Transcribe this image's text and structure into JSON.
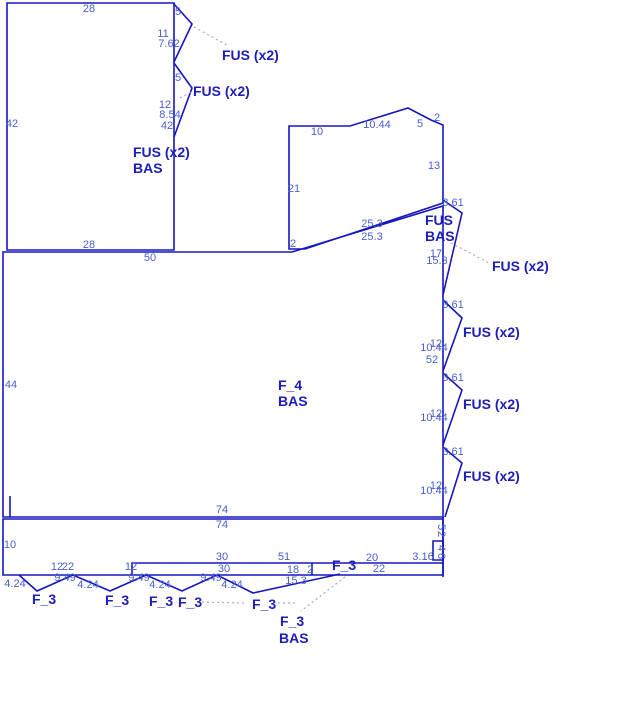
{
  "diagram": {
    "title": "structural layout sketch",
    "colors": {
      "background": "#ffffff",
      "line": "#1616c0",
      "dim_text": "#4a5ed2",
      "label_text": "#1d1db8",
      "leader": "#a0aadc"
    },
    "shapes_closed": [
      {
        "name": "rect-top-left",
        "points": "7,3 174,3 174,250 7,250"
      },
      {
        "name": "shape-upper-right",
        "points": "289,126 350,126 408,108 431,120 443,125 443,203 305,249 289,249"
      },
      {
        "name": "panel-f4",
        "points": "3,252 292,252 443,206 443,517 3,517"
      },
      {
        "name": "strip-bottom",
        "points": "3,519 443,519 443,575 3,575"
      },
      {
        "name": "small-rect",
        "points": "433,541 443,541 443,560 433,560"
      }
    ],
    "shapes_open": [
      {
        "name": "flag-top-1",
        "points": "174,4 192,24 174,62"
      },
      {
        "name": "flag-top-2",
        "points": "174,63 192,88 174,137"
      },
      {
        "name": "flag-right-1",
        "points": "443,200 462,213 443,295"
      },
      {
        "name": "flag-right-2",
        "points": "443,300 462,318 443,371"
      },
      {
        "name": "flag-right-3",
        "points": "443,373 462,390 443,445"
      },
      {
        "name": "flag-right-4",
        "points": "443,447 462,463 445,517"
      },
      {
        "name": "rib-rect",
        "points": "132,575 132,563 443,563"
      },
      {
        "name": "tri-1",
        "points": "19,575 37,591 73,575"
      },
      {
        "name": "tri-2",
        "points": "73,575 110,591 146,575"
      },
      {
        "name": "tri-3",
        "points": "146,575 182,591 217,575"
      },
      {
        "name": "tri-4",
        "points": "217,575 253,593 340,574"
      }
    ],
    "segments": [
      {
        "name": "rib-divider",
        "x1": 312,
        "y1": 563,
        "x2": 312,
        "y2": 575
      },
      {
        "name": "left-stub",
        "x1": 10,
        "y1": 496,
        "x2": 10,
        "y2": 517
      },
      {
        "name": "main-vertical-lower",
        "x1": 443,
        "y1": 517,
        "x2": 443,
        "y2": 577
      }
    ],
    "leaders": [
      {
        "name": "leader-fus-top-1",
        "x1": 194,
        "y1": 27,
        "x2": 227,
        "y2": 45
      },
      {
        "name": "leader-fus-top-2",
        "x1": 180,
        "y1": 98,
        "x2": 191,
        "y2": 92
      },
      {
        "name": "leader-fus-right-1",
        "x1": 451,
        "y1": 243,
        "x2": 489,
        "y2": 263
      },
      {
        "name": "leader-f3-a",
        "x1": 197,
        "y1": 602,
        "x2": 245,
        "y2": 603
      },
      {
        "name": "leader-f3-b",
        "x1": 278,
        "y1": 603,
        "x2": 298,
        "y2": 603
      },
      {
        "name": "leader-f3-bas",
        "x1": 345,
        "y1": 577,
        "x2": 301,
        "y2": 611
      }
    ],
    "dims": [
      {
        "t": "28",
        "x": 89,
        "y": 12
      },
      {
        "t": "42",
        "x": 12,
        "y": 127
      },
      {
        "t": "5",
        "x": 178,
        "y": 15
      },
      {
        "t": "11",
        "x": 163,
        "y": 37
      },
      {
        "t": "7.62",
        "x": 169,
        "y": 47
      },
      {
        "t": "5",
        "x": 178,
        "y": 81
      },
      {
        "t": "12",
        "x": 165,
        "y": 108
      },
      {
        "t": "8.54",
        "x": 170,
        "y": 118
      },
      {
        "t": "42",
        "x": 167,
        "y": 129
      },
      {
        "t": "28",
        "x": 89,
        "y": 248
      },
      {
        "t": "50",
        "x": 150,
        "y": 261
      },
      {
        "t": "10",
        "x": 317,
        "y": 135
      },
      {
        "t": "10.44",
        "x": 377,
        "y": 128
      },
      {
        "t": "5",
        "x": 420,
        "y": 127
      },
      {
        "t": "2",
        "x": 437,
        "y": 121
      },
      {
        "t": "13",
        "x": 434,
        "y": 169
      },
      {
        "t": "21",
        "x": 294,
        "y": 192
      },
      {
        "t": "25.3",
        "x": 372,
        "y": 227
      },
      {
        "t": "25.3",
        "x": 372,
        "y": 240
      },
      {
        "t": "2",
        "x": 293,
        "y": 247
      },
      {
        "t": "3.61",
        "x": 453,
        "y": 206
      },
      {
        "t": "17",
        "x": 436,
        "y": 257
      },
      {
        "t": "15.3",
        "x": 437,
        "y": 264
      },
      {
        "t": "3.61",
        "x": 453,
        "y": 308
      },
      {
        "t": "12",
        "x": 436,
        "y": 347
      },
      {
        "t": "10.44",
        "x": 434,
        "y": 351
      },
      {
        "t": "52",
        "x": 432,
        "y": 363
      },
      {
        "t": "3.61",
        "x": 453,
        "y": 381
      },
      {
        "t": "12",
        "x": 436,
        "y": 417
      },
      {
        "t": "10.44",
        "x": 434,
        "y": 421
      },
      {
        "t": "3.61",
        "x": 453,
        "y": 455
      },
      {
        "t": "12",
        "x": 436,
        "y": 489
      },
      {
        "t": "10.44",
        "x": 434,
        "y": 494
      },
      {
        "t": "44",
        "x": 11,
        "y": 388
      },
      {
        "t": "74",
        "x": 222,
        "y": 513
      },
      {
        "t": "74",
        "x": 222,
        "y": 528
      },
      {
        "t": "10",
        "x": 10,
        "y": 548
      },
      {
        "t": "12",
        "x": 57,
        "y": 570
      },
      {
        "t": "22",
        "x": 68,
        "y": 570
      },
      {
        "t": "12",
        "x": 131,
        "y": 570
      },
      {
        "t": "30",
        "x": 222,
        "y": 560
      },
      {
        "t": "30",
        "x": 224,
        "y": 572
      },
      {
        "t": "51",
        "x": 284,
        "y": 560
      },
      {
        "t": "18",
        "x": 293,
        "y": 573
      },
      {
        "t": "2",
        "x": 310,
        "y": 573
      },
      {
        "t": "20",
        "x": 372,
        "y": 561
      },
      {
        "t": "22",
        "x": 379,
        "y": 572
      },
      {
        "t": "3.16",
        "x": 423,
        "y": 560
      },
      {
        "t": "9.49",
        "x": 65,
        "y": 581
      },
      {
        "t": "9.49",
        "x": 139,
        "y": 581
      },
      {
        "t": "9.49",
        "x": 211,
        "y": 581
      },
      {
        "t": "4.24",
        "x": 15,
        "y": 587
      },
      {
        "t": "4.24",
        "x": 88,
        "y": 588
      },
      {
        "t": "4.24",
        "x": 160,
        "y": 588
      },
      {
        "t": "4.24",
        "x": 232,
        "y": 588
      },
      {
        "t": "15.3",
        "x": 296,
        "y": 584
      },
      {
        "t": "5",
        "x": 438,
        "y": 527,
        "rot": 90
      },
      {
        "t": "2",
        "x": 438,
        "y": 534,
        "rot": 90
      },
      {
        "t": "4",
        "x": 438,
        "y": 548,
        "rot": 90
      },
      {
        "t": "6",
        "x": 438,
        "y": 556,
        "rot": 90
      }
    ],
    "labels": [
      {
        "t": "FUS (x2)",
        "x": 222,
        "y": 60
      },
      {
        "t": "FUS (x2)",
        "x": 193,
        "y": 96
      },
      {
        "t": "FUS (x2)",
        "x": 133,
        "y": 157
      },
      {
        "t": "BAS",
        "x": 133,
        "y": 173
      },
      {
        "t": "FUS",
        "x": 425,
        "y": 225
      },
      {
        "t": "BAS",
        "x": 425,
        "y": 241
      },
      {
        "t": "FUS (x2)",
        "x": 492,
        "y": 271
      },
      {
        "t": "FUS (x2)",
        "x": 463,
        "y": 337
      },
      {
        "t": "FUS (x2)",
        "x": 463,
        "y": 409
      },
      {
        "t": "FUS (x2)",
        "x": 463,
        "y": 481
      },
      {
        "t": "F_4",
        "x": 278,
        "y": 390
      },
      {
        "t": "BAS",
        "x": 278,
        "y": 406
      },
      {
        "t": "F_3",
        "x": 32,
        "y": 604
      },
      {
        "t": "F_3",
        "x": 105,
        "y": 605
      },
      {
        "t": "F_3",
        "x": 149,
        "y": 606
      },
      {
        "t": "F_3",
        "x": 178,
        "y": 607
      },
      {
        "t": "F_3",
        "x": 252,
        "y": 609
      },
      {
        "t": "F_3",
        "x": 332,
        "y": 570
      },
      {
        "t": "F_3",
        "x": 280,
        "y": 626
      },
      {
        "t": "BAS",
        "x": 279,
        "y": 643
      }
    ]
  }
}
